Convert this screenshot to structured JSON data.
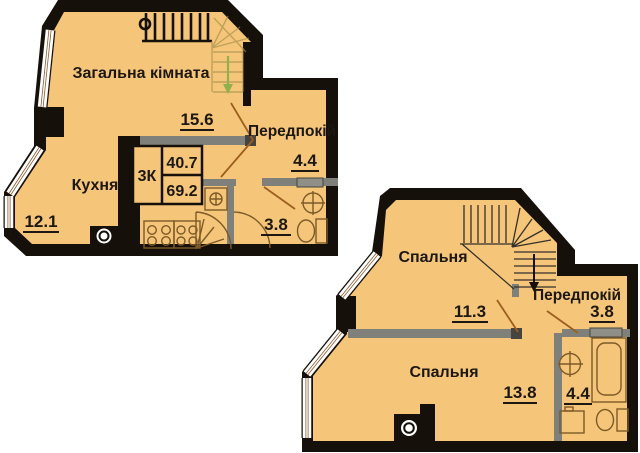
{
  "colors": {
    "background": "#ffffff",
    "floor": "#f5c67a",
    "wall": "#16100a",
    "partition": "#80807a",
    "partition_dark": "#45443e",
    "door_leaf": "#8f8f88",
    "window_line": "#8a5a2e",
    "door_swing": "#9c5e1f",
    "fixture": "#7d5a28",
    "stair_faded": "#a08a46",
    "stair_arrow": "#8fb04c",
    "stair_tread_dark": "#35312a",
    "text": "#1d1712"
  },
  "plan_upper": {
    "rooms": {
      "living": {
        "label": "Загальна кімната",
        "area": "15.6"
      },
      "hall": {
        "label": "Передпокій",
        "area": "4.4"
      },
      "kitchen": {
        "label": "Кухня",
        "area": "12.1"
      },
      "bathroom": {
        "area": "3.8"
      }
    },
    "info_box": {
      "rooms_code": "3К",
      "living_area": "40.7",
      "total_area": "69.2"
    }
  },
  "plan_lower": {
    "rooms": {
      "bedroom1": {
        "label": "Спальня",
        "area": "11.3"
      },
      "hall": {
        "label": "Передпокій",
        "area": "3.8"
      },
      "bedroom2": {
        "label": "Спальня",
        "area": "13.8"
      },
      "bathroom": {
        "area": "4.4"
      }
    }
  }
}
